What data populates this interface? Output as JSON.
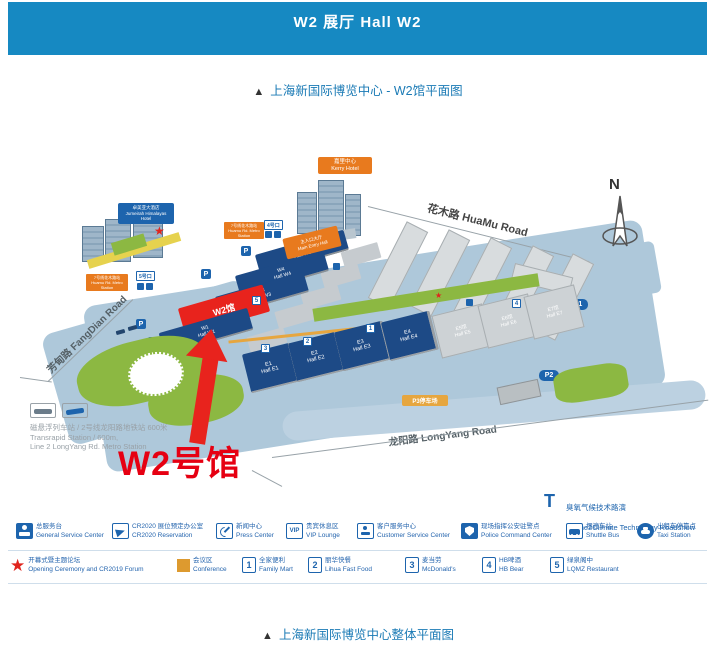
{
  "header": {
    "title": "W2 展厅  Hall W2"
  },
  "captions": {
    "top_triangle": "▲",
    "top": "上海新国际博览中心 - W2馆平面图",
    "bottom_triangle": "▲",
    "bottom": "上海新国际博览中心整体平面图"
  },
  "colors": {
    "header_bg": "#1689c2",
    "hall_blue": "#1d4a86",
    "highlight_red": "#e8231d",
    "accent_orange": "#e87a1e",
    "legend_blue": "#2565ae",
    "ground_blue": "#aec8da",
    "lawn_green": "#8cb842",
    "gray_hall": "#cdd2d5"
  },
  "icons": {
    "star": "★"
  },
  "map": {
    "north": "N",
    "roads": {
      "huamu": "花木路 HuaMu Road",
      "fangdian": "芳甸路 FangDian Road",
      "longyang": "龙阳路 LongYang Road"
    },
    "halls": {
      "w5": "W5\nHall W5",
      "w4": "W4\nHall W4",
      "w3": "W3\nHall W3",
      "w2": "W2馆",
      "w1": "W1\nHall W1",
      "e1": "E1\nHall E1",
      "e2": "E2\nHall E2",
      "e3": "E3\nHall E3",
      "e4": "E4\nHall E4",
      "e5": "E5馆\nHall E5",
      "e6": "E6馆\nHall E6",
      "e7": "E7馆\nHall E7"
    },
    "labels": {
      "kerry": "嘉里中心\nKerry Hotel",
      "jumeirah": "卓美亚大酒店\nJumeirah Himalayas Hotel",
      "metro_north": "7号线花木路站\nHuamu Rd. Metro Station",
      "metro_west": "7号线花木路站\nHuamu Rd. Metro Station",
      "exit4": "4号口",
      "exit5": "5号口",
      "badge_center": "证件中心\nBadge Center",
      "main_entry": "主入口大厅\nMain Entry Hall",
      "p1": "P1",
      "p2": "P2",
      "p3": "P3停车场",
      "parking": "P"
    },
    "food_markers": [
      "1",
      "2",
      "3",
      "4",
      "5"
    ],
    "callout": "W2号馆",
    "note": {
      "line1": "磁悬浮列车站 / 2号线龙阳路地铁站  600米",
      "line2": "Transrapid Station / 600m,",
      "line3": "Line 2 LongYang Rd. Metro Station"
    }
  },
  "ozone": {
    "icon": "T",
    "zh": "臭氧气候技术路演",
    "en": "Ozone2Climate Technology Roadshow"
  },
  "legend_row1": [
    {
      "zh": "总服务台",
      "en": "General Service Center"
    },
    {
      "zh": "CR2020 展位预定办公室",
      "en": "CR2020 Reservation"
    },
    {
      "zh": "新闻中心",
      "en": "Press Center"
    },
    {
      "zh": "贵宾休息区",
      "en": "VIP Lounge",
      "icon_text": "VIP"
    },
    {
      "zh": "客户服务中心",
      "en": "Customer Service Center"
    },
    {
      "zh": "现场指挥公安驻警点",
      "en": "Police Command Center"
    },
    {
      "zh": "摆渡车站",
      "en": "Shuttle Bus"
    },
    {
      "zh": "出租车停靠点",
      "en": "Taxi Station"
    }
  ],
  "legend_row2": [
    {
      "zh": "开幕式暨主题论坛",
      "en": "Opening Ceremony and CR2019 Forum"
    },
    {
      "zh": "会议区",
      "en": "Conference"
    },
    {
      "num": "1",
      "zh": "全家便利",
      "en": "Family Mart"
    },
    {
      "num": "2",
      "zh": "丽华快餐",
      "en": "Lihua Fast Food"
    },
    {
      "num": "3",
      "zh": "麦当劳",
      "en": "McDonald's"
    },
    {
      "num": "4",
      "zh": "HB啤酒",
      "en": "HB Bear"
    },
    {
      "num": "5",
      "zh": "绿泉阁中",
      "en": "LQMZ Restaurant"
    }
  ]
}
